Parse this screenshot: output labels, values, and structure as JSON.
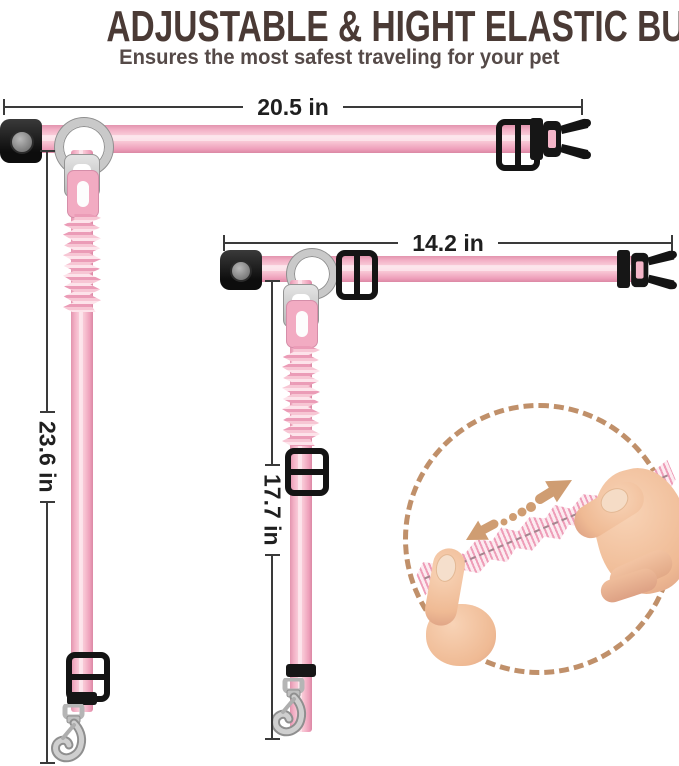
{
  "header": {
    "title": "ADJUSTABLE & HIGHT ELASTIC BUNGEE",
    "subtitle": "Ensures the most safest traveling for your pet"
  },
  "leash_long": {
    "horizontal_label": "20.5 in",
    "vertical_label": "23.6 in"
  },
  "leash_short": {
    "horizontal_label": "14.2 in",
    "vertical_label": "17.7 in"
  },
  "inset": {
    "stretch_arrow_icon": "double-headed-dotted-arrow",
    "subject": "elastic-bungee-stretched-by-hands"
  },
  "colors": {
    "title_text": "#4a3a35",
    "subtitle_text": "#554a48",
    "dimension_text": "#1f1f1f",
    "dimension_line": "#3a3a3a",
    "strap_pink": "#f5b6c9",
    "strap_pink_light": "#fbd3de",
    "strap_pink_dark": "#db88a4",
    "hardware_black": "#141414",
    "metal_silver": "#c9c9c9",
    "accent_tan": "#c0906a",
    "skin_tone": "#f3c5a6"
  }
}
